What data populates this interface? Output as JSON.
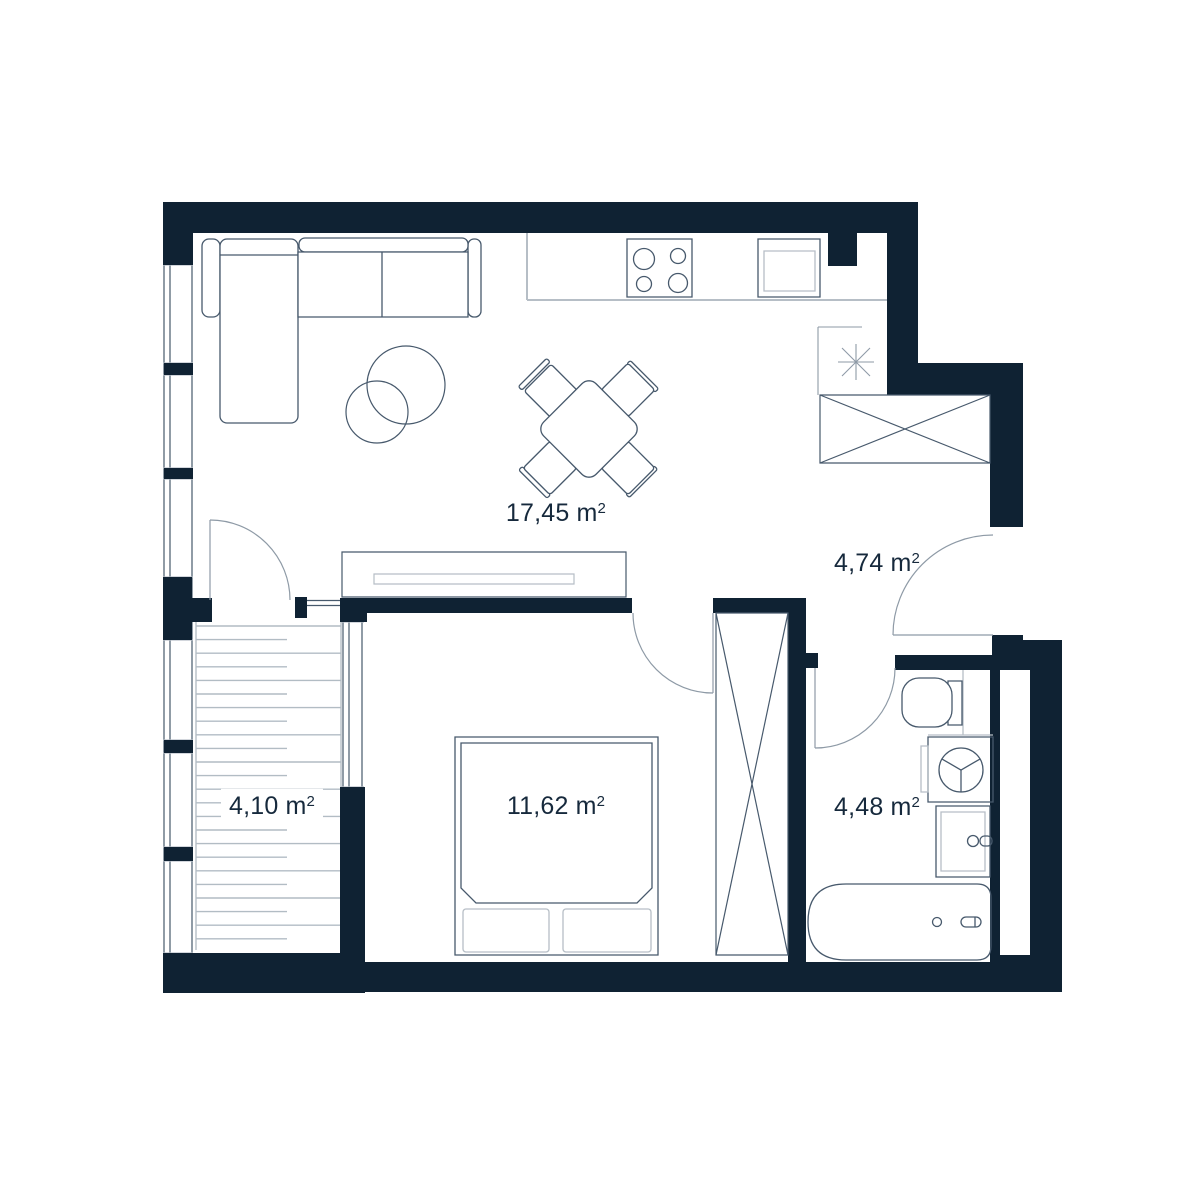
{
  "theme": {
    "wall_color": "#0f2233",
    "line_color": "#47596c",
    "soft_line_color": "#8e9aa6",
    "gray_color": "#b6bec6",
    "deck_color": "#b2bcc4",
    "text_color": "#16293c",
    "background": "#ffffff"
  },
  "rooms": [
    {
      "id": "living-kitchen",
      "area": "17,45",
      "unit_base": "m",
      "unit_sup": "2"
    },
    {
      "id": "hallway",
      "area": "4,74",
      "unit_base": "m",
      "unit_sup": "2"
    },
    {
      "id": "balcony",
      "area": "4,10",
      "unit_base": "m",
      "unit_sup": "2"
    },
    {
      "id": "bedroom",
      "area": "11,62",
      "unit_base": "m",
      "unit_sup": "2"
    },
    {
      "id": "bathroom",
      "area": "4,48",
      "unit_base": "m",
      "unit_sup": "2"
    }
  ],
  "balcony_deck": {
    "top": 626,
    "bottom": 950,
    "step": 13.6,
    "x1": 196,
    "x2_full": 341,
    "x2_short": 287
  }
}
